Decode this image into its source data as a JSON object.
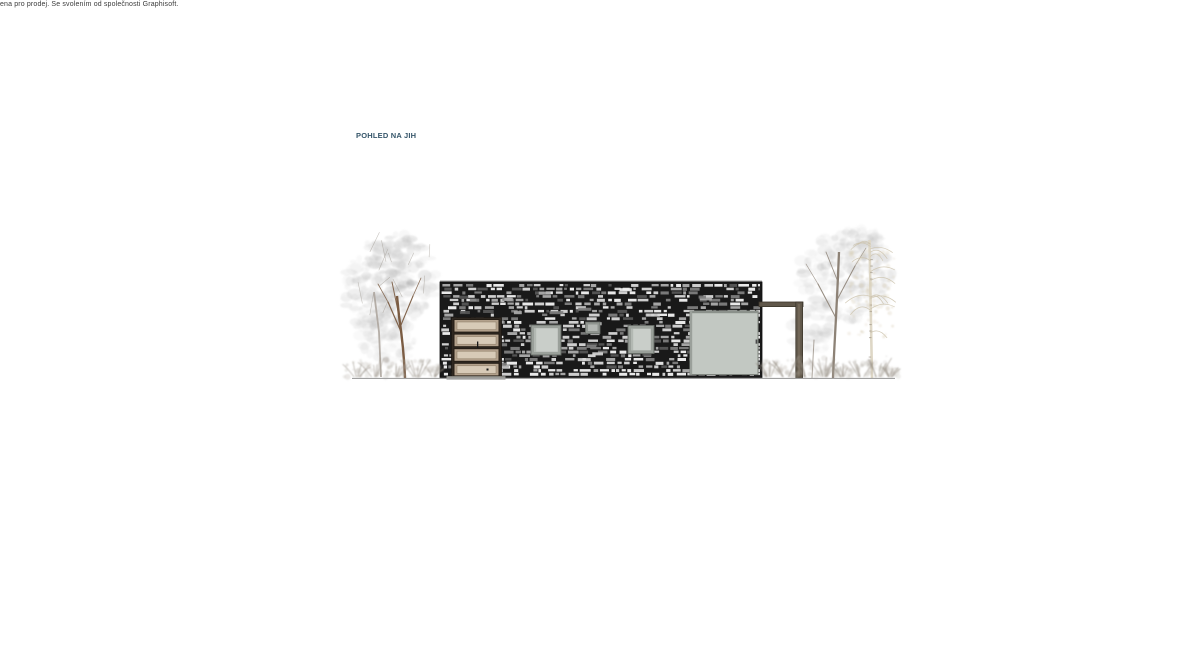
{
  "page": {
    "background": "#ffffff"
  },
  "watermark": {
    "text": "ena pro prodej. Se svolením od společnosti Graphisoft."
  },
  "drawing": {
    "title": "POHLED NA JIH"
  },
  "colors": {
    "title_text": "#36566a",
    "watermark_text": "#3a3a3a",
    "stone_bg": "#191919",
    "stone_lights": [
      "#f4f4f4",
      "#d8d8d8",
      "#adadad",
      "#7e7e7e",
      "#565656"
    ],
    "facade_top_band": "#a9a9a9",
    "door_frame": "#2f2821",
    "door_panel": "#b3a18c",
    "door_panel_inner": "#d7cab7",
    "door_threshold": "#9a9a95",
    "window_frame": "#9aa09a",
    "window_glass": "#c9cec9",
    "window_edge": "#676c67",
    "glazing_fill": "#c2c8c2",
    "glazing_edge": "#80867f",
    "pergola": "#60574a",
    "pergola_dark": "#3e372d",
    "ground_line": "#a0a0a0",
    "foliage_grays": [
      "#cccccc",
      "#c0c0c0",
      "#b4b4b4",
      "#a6a6a6",
      "#d6d6d6"
    ],
    "trunk_brown": "#7b5c43",
    "trunk_gray": "#8d8276",
    "trunk_back": "#aaa29a",
    "birch_trunk": "#ded7c6",
    "birch_mark": "#8a8070",
    "birch_branch": "#cbc2ac",
    "birch_leaf": "#d5cab0",
    "bush_twig": "#8d857b",
    "bush_leaf": "#aaa49b"
  }
}
